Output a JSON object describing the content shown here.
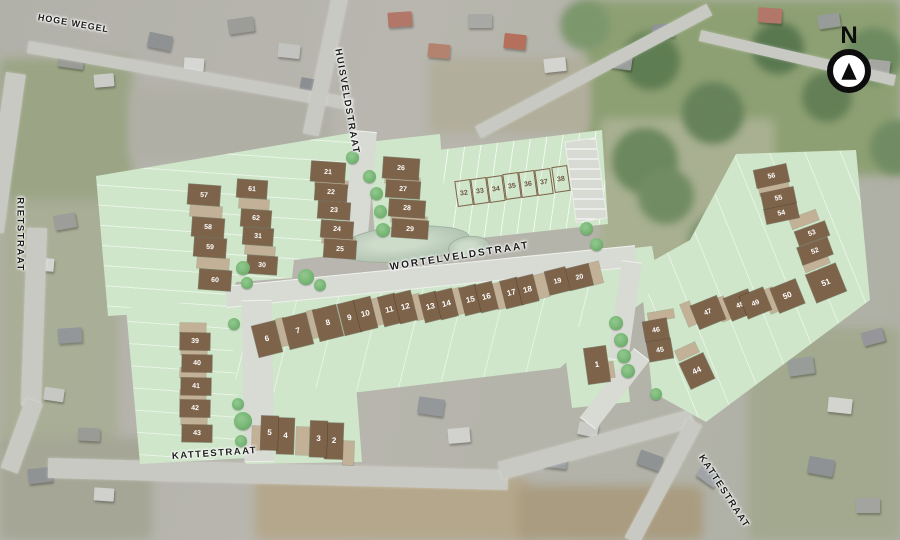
{
  "compass": {
    "label": "N"
  },
  "streets": {
    "hoge_wegel": "HOGE WEGEL",
    "huisveldstraat": "HUISVELDSTRAAT",
    "rietstraat": "RIETSTRAAT",
    "wortelveldstraat": "WORTELVELDSTRAAT",
    "kattestraat_left": "KATTESTRAAT",
    "kattestraat_right": "KATTESTRAAT"
  },
  "colors": {
    "plan_green": "#cfe6ca",
    "lot_brown": "#7d6349",
    "garage_tan": "#c2b197",
    "tree_green": "#74b472",
    "road_gray": "#d8dad4"
  },
  "lots": [
    [
      1,
      586,
      347,
      22,
      36,
      -8,
      "d"
    ],
    [
      2,
      325,
      423,
      18,
      36,
      2,
      "d"
    ],
    [
      3,
      310,
      421,
      17,
      36,
      2,
      "d"
    ],
    [
      4,
      277,
      418,
      17,
      36,
      2,
      "d"
    ],
    [
      5,
      261,
      416,
      17,
      34,
      2,
      "d"
    ],
    [
      6,
      255,
      323,
      24,
      32,
      -14,
      "d"
    ],
    [
      7,
      286,
      315,
      24,
      32,
      -14,
      "d"
    ],
    [
      8,
      316,
      307,
      24,
      32,
      -14,
      "d"
    ],
    [
      9,
      341,
      302,
      17,
      32,
      -14,
      "d"
    ],
    [
      10,
      357,
      298,
      17,
      32,
      -14,
      "d"
    ],
    [
      11,
      381,
      295,
      17,
      30,
      -14,
      "d"
    ],
    [
      12,
      397,
      292,
      17,
      30,
      -14,
      "d"
    ],
    [
      13,
      422,
      293,
      17,
      28,
      -14,
      "d"
    ],
    [
      14,
      438,
      290,
      17,
      28,
      -14,
      "d"
    ],
    [
      15,
      462,
      286,
      17,
      28,
      -14,
      "d"
    ],
    [
      16,
      478,
      283,
      17,
      28,
      -14,
      "d"
    ],
    [
      17,
      503,
      279,
      17,
      28,
      -14,
      "d"
    ],
    [
      18,
      519,
      276,
      17,
      27,
      -14,
      "d"
    ],
    [
      19,
      547,
      269,
      21,
      24,
      -14,
      "d"
    ],
    [
      20,
      568,
      266,
      23,
      22,
      -14,
      "d"
    ],
    [
      21,
      311,
      162,
      34,
      20,
      4,
      "d"
    ],
    [
      22,
      315,
      184,
      32,
      17,
      4,
      "d"
    ],
    [
      23,
      318,
      202,
      32,
      17,
      4,
      "d"
    ],
    [
      24,
      321,
      221,
      32,
      17,
      4,
      "d"
    ],
    [
      25,
      324,
      240,
      32,
      18,
      4,
      "d"
    ],
    [
      26,
      383,
      158,
      36,
      21,
      4,
      "d"
    ],
    [
      27,
      386,
      181,
      34,
      17,
      4,
      "d"
    ],
    [
      28,
      389,
      200,
      36,
      17,
      4,
      "d"
    ],
    [
      29,
      392,
      220,
      36,
      18,
      4,
      "d"
    ],
    [
      30,
      247,
      256,
      30,
      18,
      4,
      "d"
    ],
    [
      31,
      243,
      228,
      30,
      17,
      4,
      "d"
    ],
    [
      32,
      456,
      180,
      16,
      26,
      -8,
      "o"
    ],
    [
      33,
      472,
      178,
      16,
      26,
      -8,
      "o"
    ],
    [
      34,
      488,
      176,
      16,
      26,
      -8,
      "o"
    ],
    [
      35,
      504,
      173,
      16,
      26,
      -8,
      "o"
    ],
    [
      36,
      520,
      171,
      16,
      26,
      -8,
      "o"
    ],
    [
      37,
      536,
      169,
      16,
      26,
      -8,
      "o"
    ],
    [
      38,
      553,
      166,
      16,
      26,
      -8,
      "o"
    ],
    [
      39,
      180,
      333,
      30,
      17,
      1,
      "d"
    ],
    [
      40,
      182,
      355,
      30,
      17,
      1,
      "d"
    ],
    [
      41,
      181,
      378,
      30,
      17,
      1,
      "d"
    ],
    [
      42,
      180,
      400,
      30,
      17,
      1,
      "d"
    ],
    [
      43,
      182,
      425,
      30,
      17,
      1,
      "d"
    ],
    [
      44,
      684,
      357,
      26,
      28,
      -25,
      "d"
    ],
    [
      45,
      648,
      340,
      24,
      20,
      -10,
      "d"
    ],
    [
      46,
      644,
      320,
      24,
      20,
      -10,
      "d"
    ],
    [
      47,
      694,
      300,
      28,
      25,
      -22,
      "d"
    ],
    [
      48,
      727,
      293,
      26,
      24,
      -22,
      "d"
    ],
    [
      49,
      743,
      291,
      25,
      24,
      -22,
      "d"
    ],
    [
      50,
      774,
      283,
      27,
      26,
      -22,
      "d"
    ],
    [
      51,
      810,
      268,
      32,
      30,
      -22,
      "d"
    ],
    [
      52,
      799,
      242,
      32,
      18,
      -20,
      "d"
    ],
    [
      53,
      796,
      226,
      32,
      15,
      -20,
      "d"
    ],
    [
      54,
      765,
      206,
      33,
      15,
      -12,
      "d"
    ],
    [
      55,
      762,
      190,
      33,
      16,
      -12,
      "d"
    ],
    [
      56,
      755,
      167,
      33,
      18,
      -12,
      "d"
    ],
    [
      57,
      188,
      185,
      32,
      20,
      4,
      "d"
    ],
    [
      58,
      192,
      218,
      32,
      19,
      4,
      "d"
    ],
    [
      59,
      194,
      238,
      32,
      19,
      4,
      "d"
    ],
    [
      60,
      199,
      270,
      32,
      20,
      4,
      "d"
    ],
    [
      61,
      237,
      180,
      30,
      18,
      4,
      "d"
    ],
    [
      62,
      241,
      210,
      30,
      17,
      4,
      "d"
    ]
  ],
  "garage_strips": [
    [
      190,
      206,
      32,
      11,
      4
    ],
    [
      197,
      258,
      32,
      11,
      4
    ],
    [
      239,
      199,
      30,
      10,
      4
    ],
    [
      245,
      246,
      30,
      9,
      4
    ],
    [
      315,
      180,
      33,
      7,
      4
    ],
    [
      322,
      237,
      33,
      7,
      4
    ],
    [
      385,
      177,
      35,
      7,
      4
    ],
    [
      391,
      216,
      36,
      7,
      4
    ],
    [
      279,
      318,
      8,
      28,
      -14
    ],
    [
      310,
      310,
      8,
      28,
      -14
    ],
    [
      374,
      298,
      8,
      27,
      -14
    ],
    [
      414,
      294,
      8,
      26,
      -14
    ],
    [
      455,
      288,
      8,
      26,
      -14
    ],
    [
      495,
      283,
      8,
      26,
      -14
    ],
    [
      536,
      274,
      11,
      24,
      -14
    ],
    [
      591,
      262,
      10,
      22,
      -14
    ],
    [
      252,
      426,
      10,
      24,
      2
    ],
    [
      296,
      427,
      13,
      28,
      2
    ],
    [
      343,
      441,
      11,
      24,
      2
    ],
    [
      604,
      362,
      10,
      16,
      -8
    ],
    [
      180,
      323,
      26,
      10,
      1
    ],
    [
      181,
      345,
      26,
      10,
      1
    ],
    [
      180,
      368,
      26,
      10,
      1
    ],
    [
      180,
      390,
      26,
      10,
      1
    ],
    [
      181,
      415,
      26,
      10,
      1
    ],
    [
      676,
      346,
      22,
      11,
      -25
    ],
    [
      648,
      311,
      26,
      9,
      -10
    ],
    [
      684,
      302,
      10,
      24,
      -22
    ],
    [
      718,
      297,
      10,
      24,
      -22
    ],
    [
      766,
      288,
      11,
      25,
      -22
    ],
    [
      803,
      257,
      26,
      11,
      -22
    ],
    [
      790,
      214,
      28,
      11,
      -20
    ],
    [
      759,
      184,
      30,
      9,
      -12
    ]
  ],
  "trees": [
    [
      352,
      157,
      13
    ],
    [
      369,
      176,
      13
    ],
    [
      376,
      193,
      13
    ],
    [
      380,
      211,
      13
    ],
    [
      383,
      230,
      14
    ],
    [
      243,
      268,
      14
    ],
    [
      247,
      283,
      12
    ],
    [
      306,
      277,
      16
    ],
    [
      320,
      285,
      12
    ],
    [
      234,
      324,
      12
    ],
    [
      238,
      404,
      12
    ],
    [
      243,
      421,
      18
    ],
    [
      241,
      441,
      12
    ],
    [
      586,
      228,
      13
    ],
    [
      596,
      244,
      13
    ],
    [
      616,
      323,
      14
    ],
    [
      621,
      340,
      14
    ],
    [
      624,
      356,
      14
    ],
    [
      628,
      371,
      14
    ],
    [
      656,
      394,
      12
    ]
  ]
}
